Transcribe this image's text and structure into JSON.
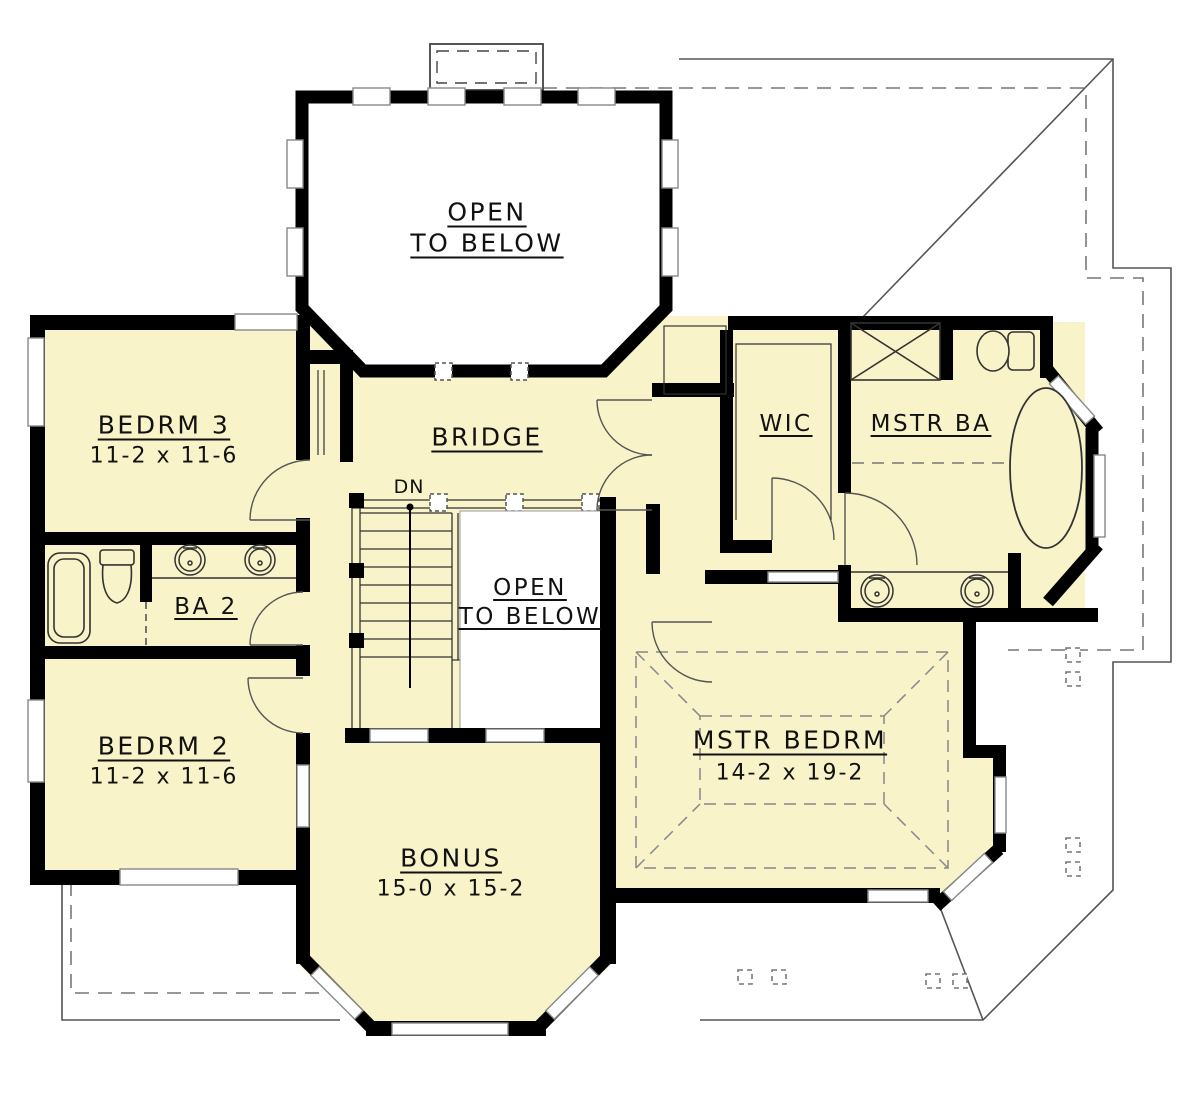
{
  "title": "Second Floor Plan",
  "colors": {
    "room_fill": "#F8F3C8",
    "wall": "#000000",
    "background": "#FFFFFF",
    "thin_line": "#333333",
    "roof_line": "#555555"
  },
  "rooms": {
    "open_below_top": {
      "line1": "OPEN",
      "line2": "TO BELOW"
    },
    "bedrm3": {
      "name": "BEDRM 3",
      "dims": "11-2 x 11-6"
    },
    "bridge": {
      "name": "BRIDGE"
    },
    "wic": {
      "name": "WIC"
    },
    "mstr_ba": {
      "name": "MSTR BA"
    },
    "ba2": {
      "name": "BA 2"
    },
    "bedrm2": {
      "name": "BEDRM 2",
      "dims": "11-2 x 11-6"
    },
    "open_below_center": {
      "line1": "OPEN",
      "line2": "TO BELOW"
    },
    "mstr_bedrm": {
      "name": "MSTR BEDRM",
      "dims": "14-2 x 19-2"
    },
    "bonus": {
      "name": "BONUS",
      "dims": "15-0 x 15-2"
    },
    "stairs": {
      "label": "DN"
    }
  },
  "fixtures": [
    "shower",
    "toilet",
    "oval-tub",
    "double-sinks-master",
    "tub-ba2",
    "toilet-ba2",
    "double-sinks-ba2",
    "stairs-down",
    "tray-ceiling"
  ]
}
